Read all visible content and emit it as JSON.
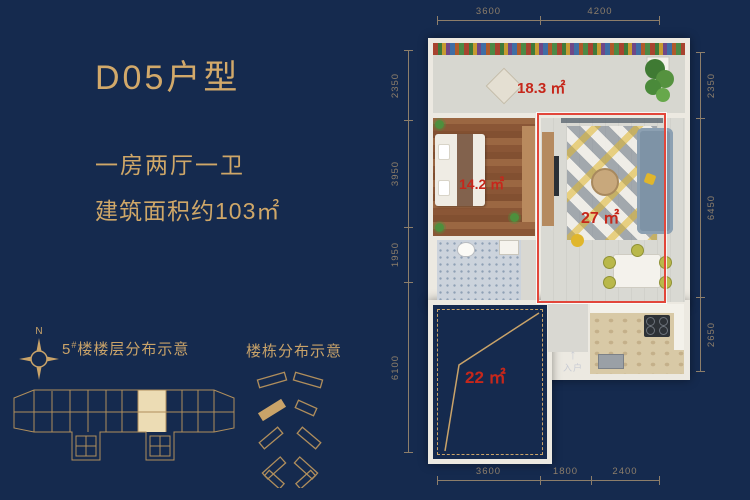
{
  "colors": {
    "background": "#152a4e",
    "gold": "#c9a369",
    "red_label": "#c6271b",
    "red_outline": "#e2463a",
    "dim": "#8d7e6a"
  },
  "panel": {
    "title": "D05户型",
    "layout_line": "一房两厅一卫",
    "area_line": "建筑面积约103㎡"
  },
  "legend": {
    "compass_n": "N",
    "floor_diagram_num": "5",
    "floor_diagram_sup": "#",
    "floor_diagram_text": "楼楼层分布示意",
    "building_diagram_label": "楼栋分布示意"
  },
  "floorplan": {
    "rooms": {
      "terrace_area": "18.3 ㎡",
      "bedroom_area": "14.2 ㎡",
      "living_area": "27 ㎡",
      "void_area": "22 ㎡"
    },
    "entry": {
      "arrow": "↑",
      "label": "入户"
    },
    "dims": {
      "top": [
        "3600",
        "4200"
      ],
      "left": [
        "2350",
        "3950",
        "1950",
        "6100"
      ],
      "right": [
        "2350",
        "6450",
        "2650"
      ],
      "bottom": [
        "3600",
        "1800",
        "2400"
      ]
    }
  }
}
